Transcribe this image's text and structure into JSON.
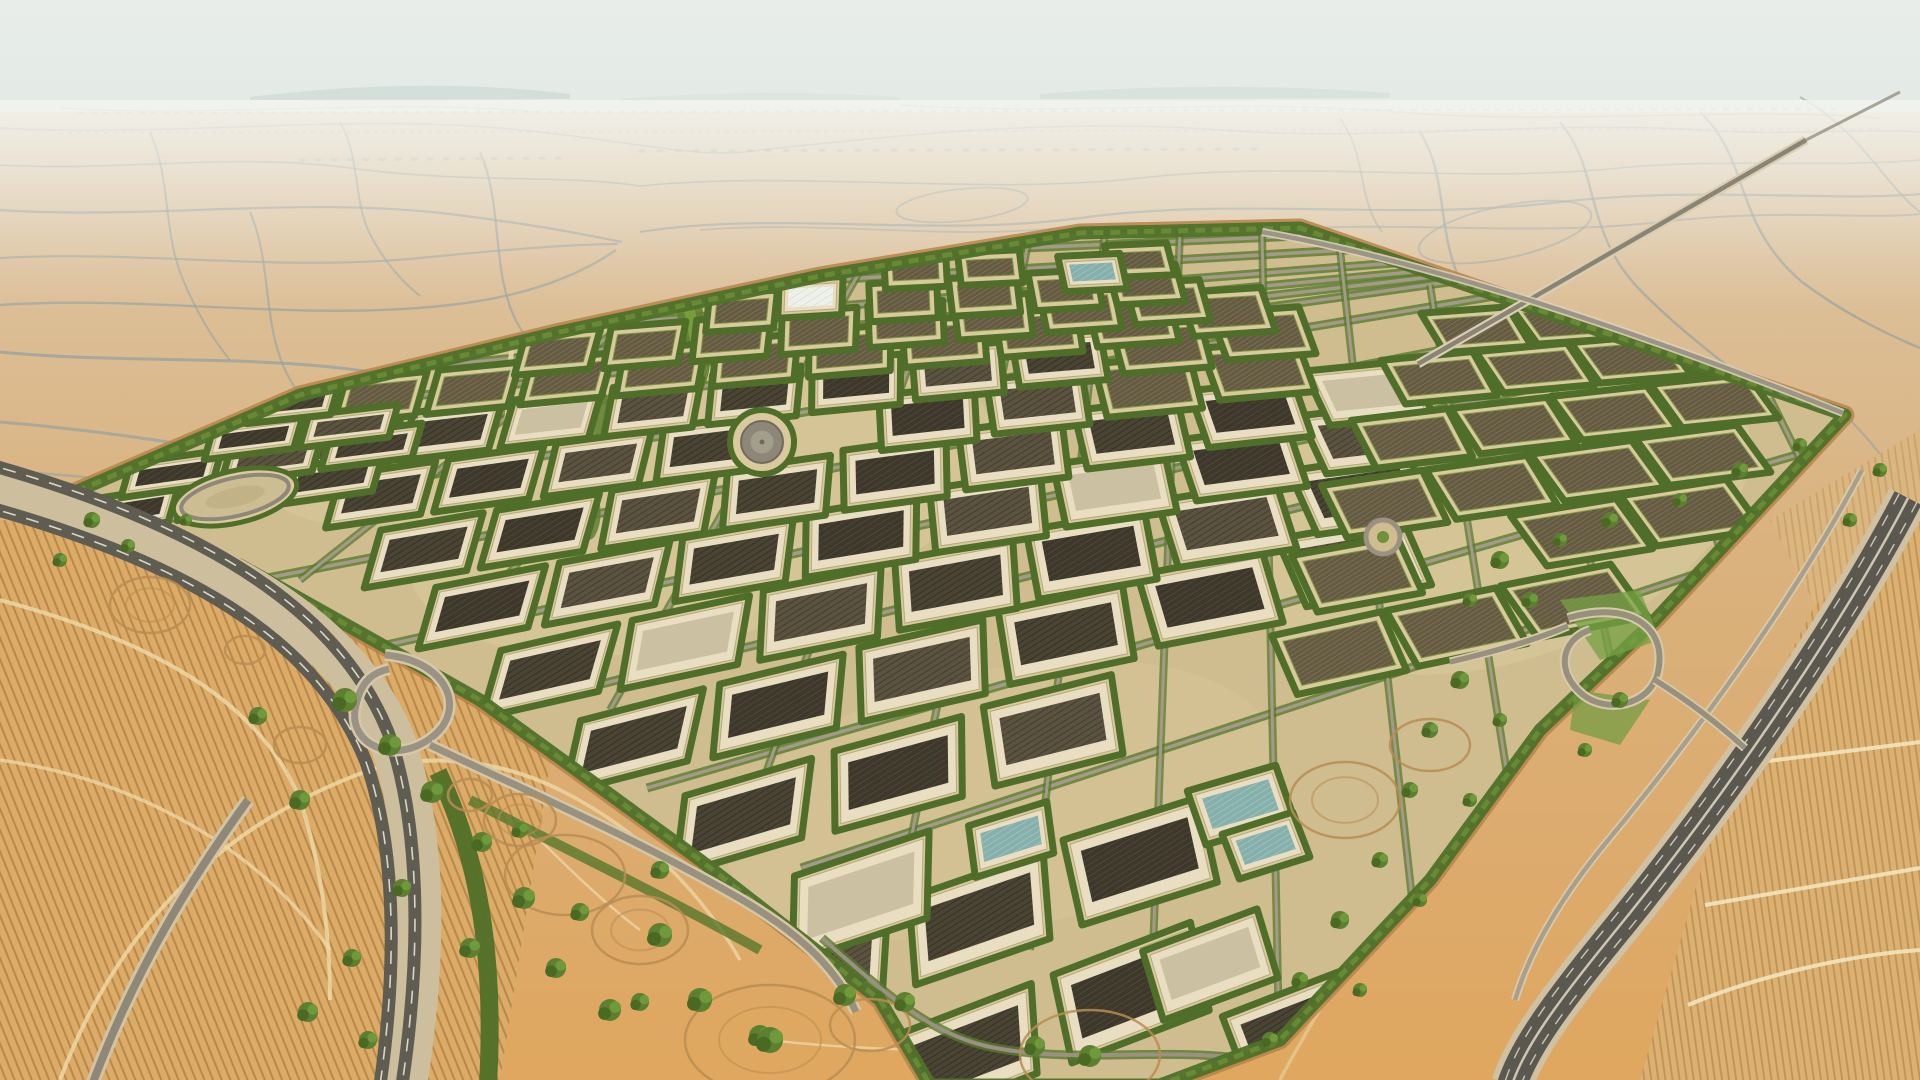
{
  "meta": {
    "description": "Aerial photograph of a vast diamond-shaped desert agricultural and industrial development: dense grid of dark greenhouse and solar plots separated by green hedgerow roads, surrounded by pale desert webbed with tracks, a curving highway at lower left, a multi-lane highway corridor on the right, plowed golden fields in the corners and a hazy pale horizon.",
    "content_type": "aerial-photograph",
    "visible_text": []
  },
  "palette": {
    "sky_top": "#e9ede9",
    "sky_mid": "#e2e9e5",
    "sky_low": "#eef1eb",
    "desert_far": "#e0d2b8",
    "desert_mid": "#d9b27e",
    "desert_near": "#dfa75f",
    "track_blue": "#94a1a0",
    "haze": "#f3f4ef",
    "complex_sand": "#cfbd8f",
    "pad_sand": "#d9c99d",
    "hedge": "#4e6e29",
    "perimeter": "#51722a",
    "perimeter_accent": "#6d9038",
    "perimeter_dirt": "#b9824a",
    "road_gray": "#a39a87",
    "road_green": "#587a2e",
    "asphalt": "#5e5b51",
    "casing": "#cfc09e",
    "lane": "#e8e4d4",
    "wall": "#e9dec1",
    "wall_edge": "#b6a77f",
    "roof_dark_a": "#4a4434",
    "roof_dark_b": "#3d382b",
    "roof_dark_c": "#5b5340",
    "roof_plain": "#cbc0a2",
    "plot_soil": "#5f563f",
    "teal_roof": "#86b0ac",
    "white_roof": "#eef0ea",
    "field_left": "#ddab68",
    "field_right": "#dcb071",
    "field_row": "#926828",
    "light_path": "#ecd6a4",
    "dirt_ring": "#b98d52",
    "tree_a": "#5d8030",
    "tree_b": "#4a6a24",
    "tree_c": "#6f9a3c",
    "strip_sand": "#e5c184"
  },
  "scene": {
    "complex_outline": "45,505 300,395 560,332 820,276 1080,233 1300,228 1845,415 1655,620 1540,730 1430,880 1280,1040 1160,1085 930,1085 880,1000 700,860 480,700 240,565",
    "rows": [
      [
        900,
        1040,
        2,
        160,
        135,
        78,
        "p"
      ],
      [
        760,
        960,
        3,
        155,
        130,
        75,
        "p"
      ],
      [
        800,
        880,
        2,
        160,
        130,
        75,
        "p"
      ],
      [
        690,
        800,
        3,
        150,
        120,
        68,
        "p"
      ],
      [
        585,
        725,
        6,
        140,
        115,
        62,
        "p"
      ],
      [
        505,
        655,
        7,
        132,
        108,
        58,
        "p"
      ],
      [
        440,
        592,
        8,
        124,
        100,
        52,
        "p"
      ],
      [
        385,
        535,
        9,
        116,
        92,
        48,
        "p"
      ],
      [
        345,
        480,
        9,
        108,
        84,
        43,
        "m"
      ],
      [
        318,
        430,
        10,
        100,
        77,
        38,
        "m"
      ],
      [
        350,
        385,
        10,
        93,
        70,
        34,
        "f"
      ],
      [
        530,
        340,
        8,
        86,
        63,
        30,
        "f"
      ],
      [
        715,
        300,
        6,
        80,
        56,
        26,
        "f"
      ],
      [
        890,
        262,
        4,
        74,
        50,
        21,
        "f"
      ],
      [
        1280,
        640,
        3,
        115,
        100,
        52,
        "f"
      ],
      [
        1300,
        560,
        4,
        110,
        95,
        50,
        "f"
      ],
      [
        1330,
        490,
        4,
        105,
        90,
        46,
        "f"
      ],
      [
        1360,
        425,
        4,
        100,
        85,
        42,
        "f"
      ],
      [
        1390,
        365,
        4,
        95,
        80,
        38,
        "f"
      ],
      [
        1430,
        318,
        3,
        90,
        75,
        34,
        "f"
      ],
      [
        1150,
        955,
        1,
        0,
        110,
        60,
        "p"
      ],
      [
        1230,
        1020,
        1,
        0,
        115,
        62,
        "p"
      ],
      [
        90,
        505,
        3,
        102,
        82,
        26,
        "p"
      ],
      [
        135,
        468,
        3,
        100,
        80,
        24,
        "p"
      ],
      [
        218,
        432,
        2,
        95,
        78,
        22,
        "p"
      ],
      [
        260,
        398,
        1,
        0,
        72,
        20,
        "p"
      ]
    ],
    "specials": [
      {
        "type": "white",
        "x": 785,
        "y": 286,
        "w": 52,
        "h": 26
      },
      {
        "type": "teal",
        "x": 975,
        "y": 830,
        "w": 70,
        "h": 40
      },
      {
        "type": "teal",
        "x": 1195,
        "y": 795,
        "w": 80,
        "h": 45
      },
      {
        "type": "teal",
        "x": 1230,
        "y": 838,
        "w": 62,
        "h": 36
      },
      {
        "type": "teal",
        "x": 1065,
        "y": 262,
        "w": 50,
        "h": 24
      },
      {
        "type": "tank",
        "x": 762,
        "y": 442,
        "r": 21
      },
      {
        "type": "oval",
        "x": 235,
        "y": 497,
        "rx": 55,
        "ry": 19,
        "rot": -13
      },
      {
        "type": "ring",
        "x": 1383,
        "y": 537,
        "r": 17
      }
    ],
    "h_roads": [
      [
        801,
        868
      ],
      [
        647,
        788
      ],
      [
        491,
        712
      ],
      [
        364,
        650
      ],
      [
        231,
        585
      ],
      [
        120,
        527
      ],
      [
        138,
        465
      ],
      [
        253,
        415
      ],
      [
        411,
        368
      ],
      [
        592,
        325
      ],
      [
        792,
        282
      ],
      [
        977,
        250
      ]
    ],
    "v_roads": [
      [
        655,
        242,
        150,
        517
      ],
      [
        730,
        240,
        300,
        580
      ],
      [
        805,
        238,
        450,
        640
      ],
      [
        880,
        236,
        610,
        710
      ],
      [
        955,
        234,
        760,
        790
      ],
      [
        1030,
        233,
        905,
        870
      ],
      [
        1105,
        231,
        1030,
        950
      ],
      [
        1180,
        230,
        1150,
        1030
      ],
      [
        1262,
        232,
        1280,
        1080
      ],
      [
        1340,
        250,
        1430,
        1060
      ],
      [
        1430,
        285,
        1530,
        920
      ],
      [
        1540,
        320,
        1640,
        800
      ],
      [
        1660,
        360,
        1755,
        660
      ],
      [
        1770,
        398,
        1850,
        560
      ]
    ],
    "trees": [
      [
        345,
        700,
        12
      ],
      [
        390,
        745,
        11
      ],
      [
        300,
        800,
        10
      ],
      [
        258,
        716,
        9
      ],
      [
        432,
        792,
        11
      ],
      [
        482,
        842,
        10
      ],
      [
        524,
        898,
        11
      ],
      [
        470,
        948,
        10
      ],
      [
        402,
        888,
        9
      ],
      [
        352,
        958,
        9
      ],
      [
        308,
        1012,
        10
      ],
      [
        368,
        1040,
        9
      ],
      [
        556,
        968,
        10
      ],
      [
        610,
        1010,
        11
      ],
      [
        660,
        935,
        12
      ],
      [
        700,
        1000,
        12
      ],
      [
        760,
        1036,
        11
      ],
      [
        770,
        1040,
        13
      ],
      [
        845,
        995,
        11
      ],
      [
        905,
        1002,
        10
      ],
      [
        640,
        1002,
        9
      ],
      [
        580,
        912,
        9
      ],
      [
        520,
        830,
        8
      ],
      [
        660,
        870,
        9
      ],
      [
        1090,
        1056,
        11
      ],
      [
        1035,
        1046,
        10
      ],
      [
        1500,
        560,
        9
      ],
      [
        1530,
        600,
        8
      ],
      [
        1470,
        600,
        7
      ],
      [
        1560,
        540,
        7
      ],
      [
        1610,
        520,
        8
      ],
      [
        1680,
        500,
        7
      ],
      [
        1740,
        470,
        8
      ],
      [
        1800,
        445,
        7
      ],
      [
        1460,
        680,
        9
      ],
      [
        1430,
        730,
        8
      ],
      [
        1500,
        720,
        7
      ],
      [
        1410,
        790,
        8
      ],
      [
        1470,
        800,
        7
      ],
      [
        1380,
        860,
        8
      ],
      [
        1340,
        920,
        9
      ],
      [
        1300,
        980,
        8
      ],
      [
        1270,
        1040,
        8
      ],
      [
        1360,
        990,
        7
      ],
      [
        1420,
        900,
        7
      ],
      [
        92,
        520,
        8
      ],
      [
        128,
        546,
        7
      ],
      [
        186,
        520,
        6
      ],
      [
        60,
        560,
        7
      ],
      [
        1880,
        470,
        7
      ],
      [
        1850,
        520,
        7
      ],
      [
        1620,
        700,
        8
      ],
      [
        1585,
        750,
        7
      ]
    ],
    "dirt_circles": [
      [
        520,
        820,
        36,
        26,
        1
      ],
      [
        640,
        930,
        48,
        34,
        1
      ],
      [
        770,
        1040,
        85,
        55,
        1
      ],
      [
        1090,
        1055,
        70,
        45,
        0
      ],
      [
        470,
        795,
        22,
        16,
        0
      ],
      [
        150,
        605,
        40,
        28,
        1
      ],
      [
        300,
        745,
        26,
        18,
        0
      ],
      [
        1345,
        800,
        55,
        38,
        1
      ],
      [
        1430,
        745,
        40,
        26,
        0
      ],
      [
        565,
        875,
        60,
        40,
        0
      ],
      [
        870,
        1025,
        40,
        26,
        0
      ],
      [
        245,
        650,
        20,
        14,
        0
      ]
    ]
  }
}
